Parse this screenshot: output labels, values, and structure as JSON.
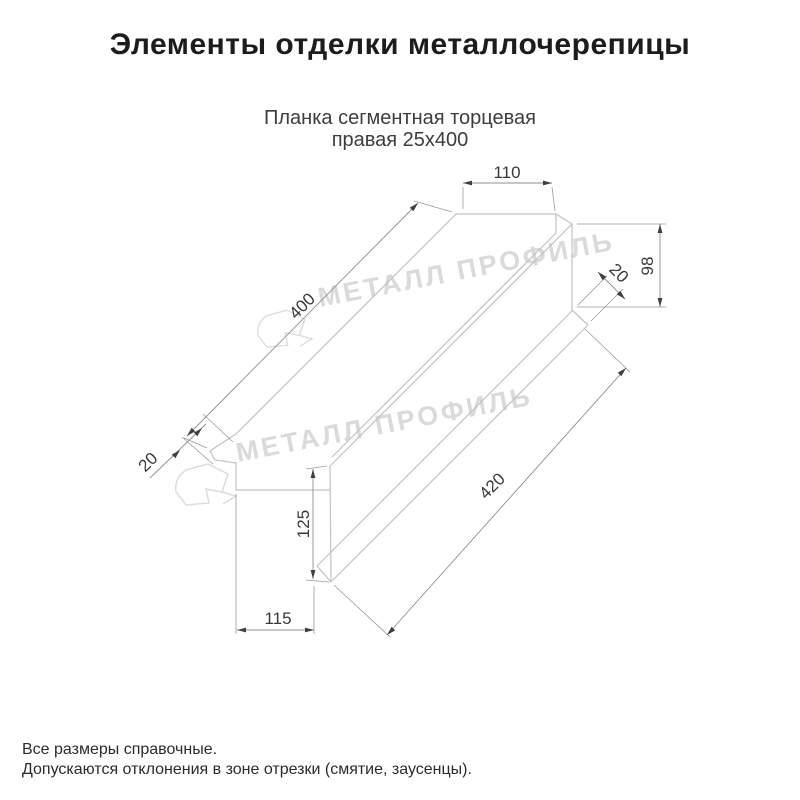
{
  "title": "Элементы отделки металлочерепицы",
  "subtitle": {
    "line1": "Планка сегментная торцевая",
    "line2": "правая 25x400"
  },
  "watermark": {
    "brand": "МЕТАЛЛ ПРОФИЛЬ"
  },
  "drawing": {
    "type": "technical-dimension-drawing",
    "dims": {
      "top_width": "110",
      "end_height": "98",
      "end_hem": "20",
      "top_length": "400",
      "flange_length": "420",
      "left_height": "125",
      "left_bottom_width": "115",
      "left_hem": "20"
    }
  },
  "footer": {
    "line1": "Все размеры справочные.",
    "line2": "Допускаются отклонения в зоне отрезки (смятие, заусенцы)."
  },
  "colors": {
    "background": "#ffffff",
    "title_text": "#1c1c1c",
    "body_text": "#2b2b2b",
    "part_line": "#c2c2c2",
    "dim_line": "#8f8f8f",
    "dim_text": "#383838",
    "watermark": "#dadada"
  }
}
